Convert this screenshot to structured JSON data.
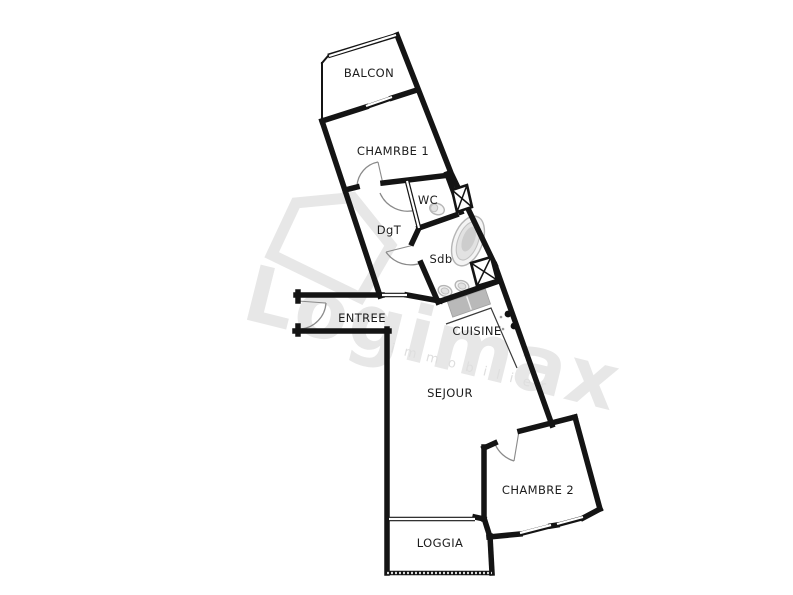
{
  "floorplan": {
    "rooms": {
      "balcon": "BALCON",
      "chambre1": "CHAMRBE 1",
      "wc": "WC",
      "dgt": "DgT",
      "sdb": "Sdb",
      "entree": "ENTREE",
      "cuisine": "CUISINE",
      "sejour": "SEJOUR",
      "chambre2": "CHAMBRE 2",
      "loggia": "LOGGIA"
    },
    "watermark": {
      "brand": "Logimax",
      "tagline": "immobilier"
    },
    "fixtures": [
      "bathtub-icon",
      "toilet-icon",
      "sink-icon",
      "sink-icon",
      "kitchen-counter",
      "stove-burners-icon",
      "shaft-x-icon",
      "shaft-x-icon"
    ],
    "colors": {
      "wall": "#141414",
      "label": "#1c1c1c",
      "fixture_outline": "#b5b5b5",
      "watermark": "#e7e7e7",
      "watermark_tagline": "#dedede",
      "background": "#ffffff"
    }
  }
}
